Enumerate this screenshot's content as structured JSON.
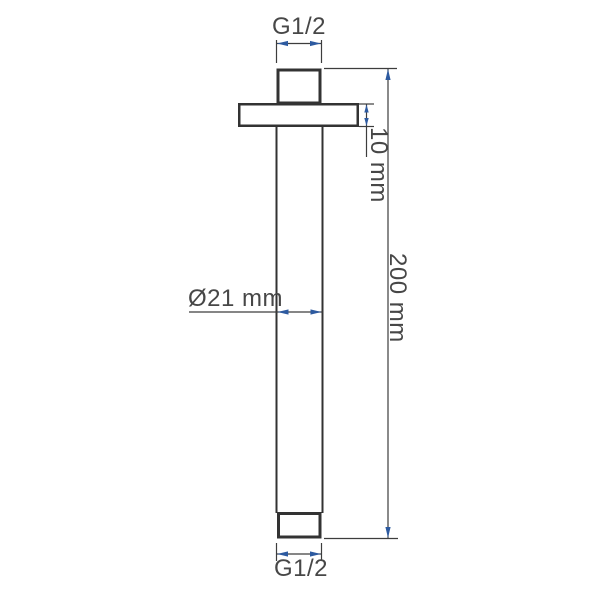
{
  "drawing": {
    "type": "technical-dimension-drawing",
    "subject": "ceiling-mount shower arm with flange",
    "labels": {
      "top_thread": "G1/2",
      "bottom_thread": "G1/2",
      "tube_diameter": "Ø21 mm",
      "flange_thickness": "10 mm",
      "overall_length": "200 mm"
    },
    "dimensions": [
      {
        "name": "top thread size",
        "value": "G1/2"
      },
      {
        "name": "flange thickness",
        "value": "10 mm"
      },
      {
        "name": "tube outer diameter",
        "value": "Ø21 mm"
      },
      {
        "name": "overall length",
        "value": "200 mm"
      },
      {
        "name": "bottom thread size",
        "value": "G1/2"
      }
    ],
    "colors": {
      "outline": "#333333",
      "dimension_line": "#3d3d3d",
      "arrowhead": "#2d5aa0",
      "text": "#474747",
      "background": "#ffffff"
    }
  }
}
